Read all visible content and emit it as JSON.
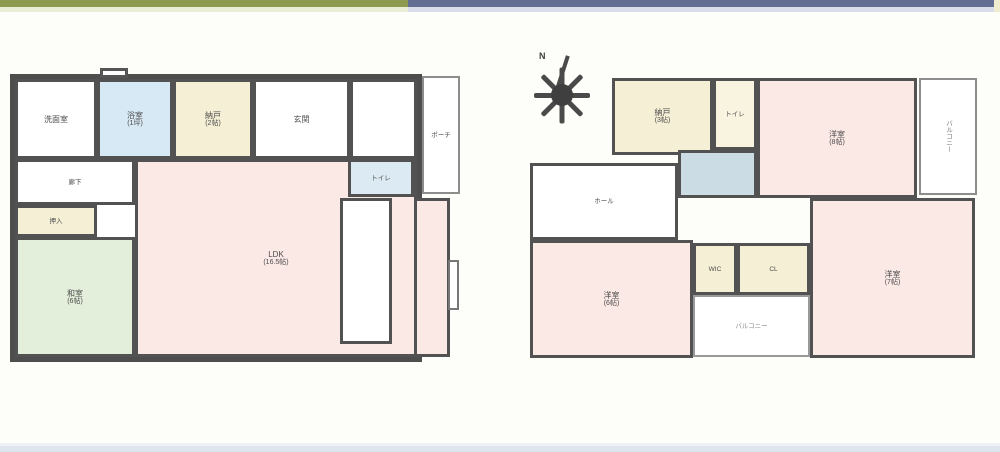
{
  "colors": {
    "bar_left": "#8e9a50",
    "bar_left_light": "#ebeed6",
    "bar_right": "#626f93",
    "bar_right_light": "#d8dde9",
    "bar_right_edge": "#f0ecd0",
    "footer_strip": "#dee5ec",
    "wall": "#525252",
    "room_pink": "#fbe9e5",
    "room_cream": "#f5efd5",
    "room_blue": "#d7e9f4",
    "room_green": "#e3efdb",
    "stairwell_blue": "#ccdce5"
  },
  "floor1": {
    "rooms": {
      "washroom": {
        "label": "洗面室"
      },
      "bath": {
        "label": "浴室",
        "size": "(1坪)"
      },
      "storage": {
        "label": "納戸",
        "size": "(2帖)"
      },
      "entrance": {
        "label": "玄関"
      },
      "corridor": {
        "label": "廊下"
      },
      "oshiire": {
        "label": "押入"
      },
      "washitsu": {
        "label": "和室",
        "size": "(6帖)"
      },
      "ldk": {
        "label": "LDK",
        "size": "(16.5帖)"
      },
      "wc": {
        "label": "トイレ"
      },
      "porch": {
        "label": "ポーチ"
      }
    }
  },
  "floor2": {
    "compass": {
      "label": "N"
    },
    "rooms": {
      "storage": {
        "label": "納戸",
        "size": "(3帖)"
      },
      "toilet": {
        "label": "トイレ"
      },
      "bed1": {
        "label": "洋室",
        "size": "(8帖)"
      },
      "balcony_east": {
        "label": "バルコニー"
      },
      "hall": {
        "label": "ホール"
      },
      "bed2": {
        "label": "洋室",
        "size": "(6帖)"
      },
      "wic1": {
        "label": "WIC"
      },
      "wic2": {
        "label": "CL"
      },
      "bed3": {
        "label": "洋室",
        "size": "(7帖)"
      },
      "balcony_south": {
        "label": "バルコニー"
      }
    }
  }
}
